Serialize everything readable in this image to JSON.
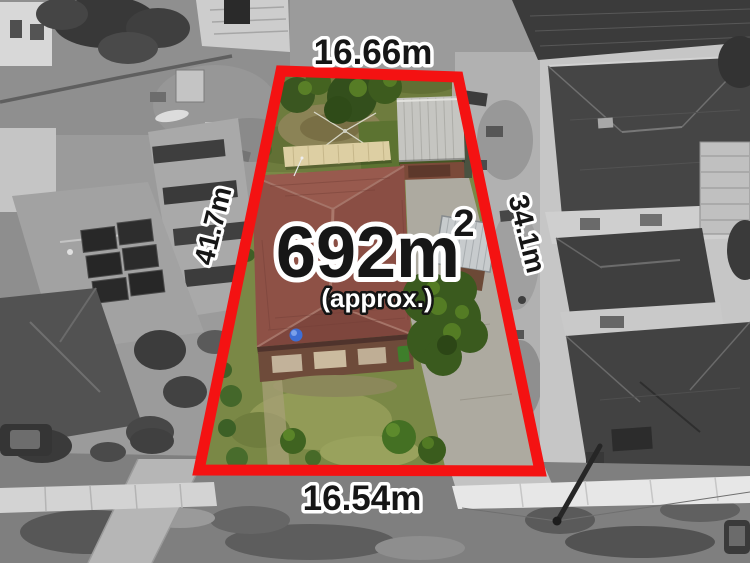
{
  "photo": {
    "kind": "aerial-drone-photo-of-residential-lot-for-sale",
    "boundary_color": "#f41212",
    "label_text_color": "#161616",
    "label_outline_color": "#ffffff"
  },
  "boundary_dimensions": {
    "top": "16.66m",
    "bottom": "16.54m",
    "left": "41.7m",
    "right": "34.1m"
  },
  "area": {
    "value": "692m",
    "exponent": "2",
    "qualifier": "(approx.)"
  }
}
